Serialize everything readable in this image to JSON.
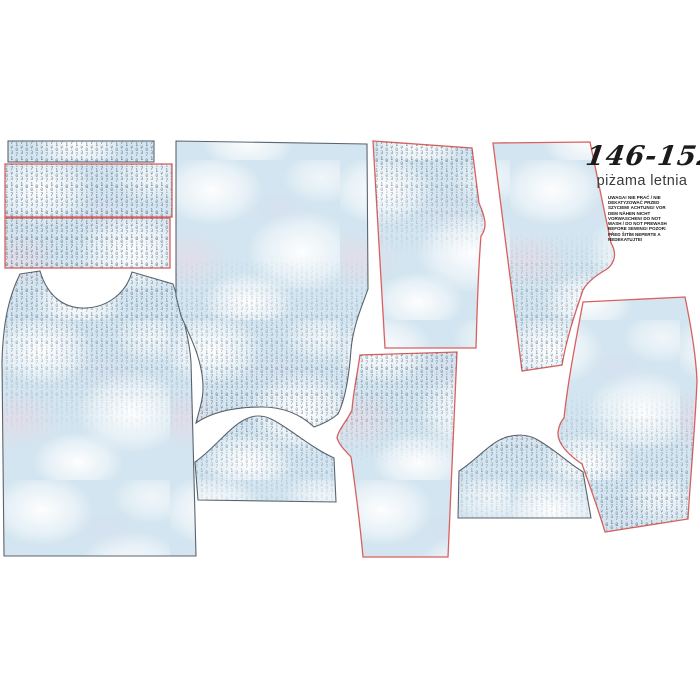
{
  "panel": {
    "size_label": "146-152",
    "product_name": "piżama letnia",
    "warning_text": "UWAGA! NIE PRAĆ / NIE DEKATYZOWAĆ PRZED SZYCIEM! ACHTUNG! VOR DEM NÄHEN NICHT VORWASCHEN! DO NOT WASH / DO NOT PREWASH BEFORE SEWING! POZOR: PŘED ŠITÍM NEPERTE A NEDEKATUJTE!"
  },
  "colors": {
    "background": "#ffffff",
    "fabric_base": "#d3e5f0",
    "print_glyphs": "#3e4f61",
    "cut_line_red": "#d9605e",
    "cut_line_dark": "#5a646e",
    "title_text": "#1b1b1b"
  },
  "pieces": [
    {
      "name": "neckband-strip",
      "outline": "dark"
    },
    {
      "name": "cuff-strip-1",
      "outline": "red"
    },
    {
      "name": "cuff-strip-2",
      "outline": "red"
    },
    {
      "name": "top-front",
      "outline": "dark"
    },
    {
      "name": "top-back",
      "outline": "dark"
    },
    {
      "name": "sleeve-left",
      "outline": "dark"
    },
    {
      "name": "sleeve-right",
      "outline": "dark"
    },
    {
      "name": "shorts-front-left",
      "outline": "red"
    },
    {
      "name": "shorts-front-right",
      "outline": "red"
    },
    {
      "name": "shorts-back-left",
      "outline": "red"
    },
    {
      "name": "shorts-back-right",
      "outline": "red"
    }
  ]
}
